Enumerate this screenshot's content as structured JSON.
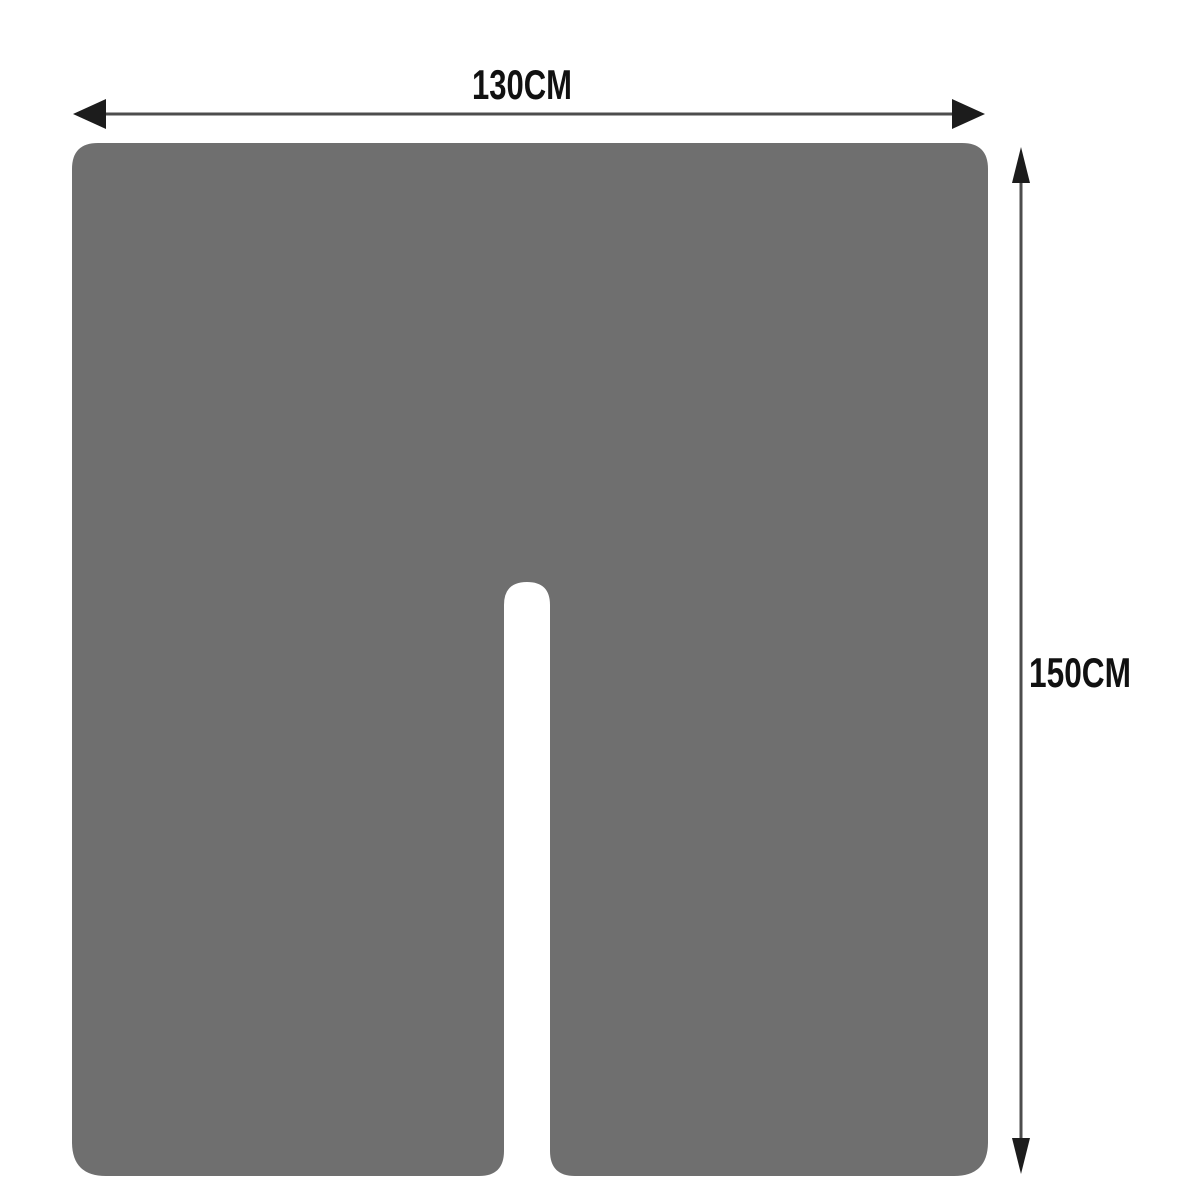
{
  "diagram": {
    "title": "sheet-with-center-slit-dimension-diagram",
    "width_label": "130CM",
    "height_label": "150CM",
    "sheet_color": "#6f6f6f",
    "background_color": "#ffffff",
    "arrow_line_color": "#4d4d4d",
    "arrowhead_color": "#1c1c1c",
    "label_color": "#111111"
  }
}
